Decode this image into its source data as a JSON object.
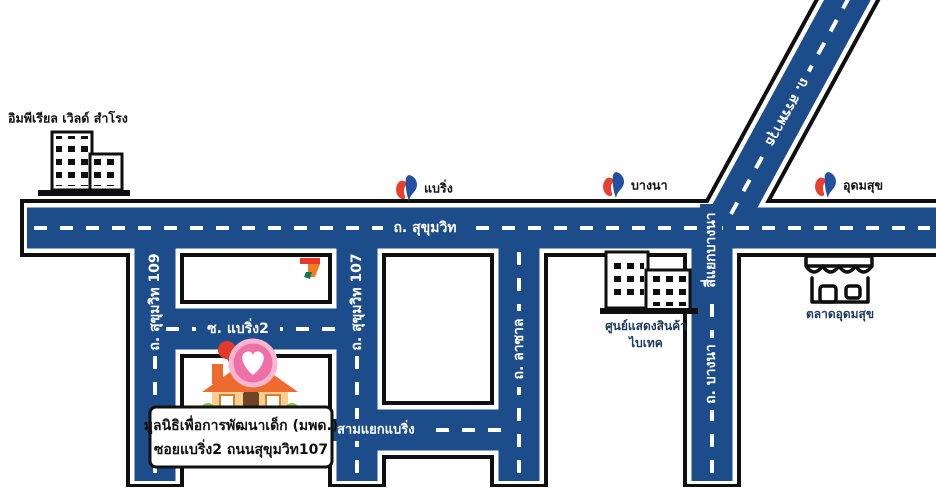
{
  "colors": {
    "road": "#1d4c8a",
    "outline": "#0f0f0f",
    "dash": "#ffffff",
    "bts_blue": "#2350a0",
    "bts_red": "#e8402d",
    "pin_red": "#e03a2a",
    "heart_pink": "#ef6fa9",
    "heart_ring": "#f8b7d0",
    "roof_orange": "#ed6b2f",
    "house_body": "#f9cf8e",
    "door_brown": "#6e4426",
    "bush_green": "#8bc34a",
    "seven_red": "#e8392c",
    "seven_orange": "#f47b20",
    "seven_green": "#0b7b53"
  },
  "roads": {
    "main": "ถ. สุขุมวิท",
    "diagonal": "ถ. สรรพาวุธ",
    "s109": "ถ. สุขุมวิท 109",
    "s107": "ถ. สุขุมวิท 107",
    "lasalle": "ถ. ลาซาล",
    "bangna": "ถ. บางนา",
    "soi_bearing2": "ซ. แบริ่ง2",
    "bangna_intersection": "สี่แยกบางนา",
    "bearing_junction": "สามแยกแบริ่ง"
  },
  "stations": {
    "bearing": "แบริ่ง",
    "bangna": "บางนา",
    "udomsuk": "อุดมสุข"
  },
  "landmarks": {
    "imperial_world": "อิมพีเรียล เวิลด์ สำโรง",
    "bitec_line1": "ศูนย์แสดงสินค้า",
    "bitec_line2": "ไบเทค",
    "market": "ตลาดอุดมสุข"
  },
  "callout": {
    "line1": "มูลนิธิเพื่อการพัฒนาเด็ก (มพด.)",
    "line2": "ซอยแบริ่ง2 ถนนสุขุมวิท107"
  }
}
